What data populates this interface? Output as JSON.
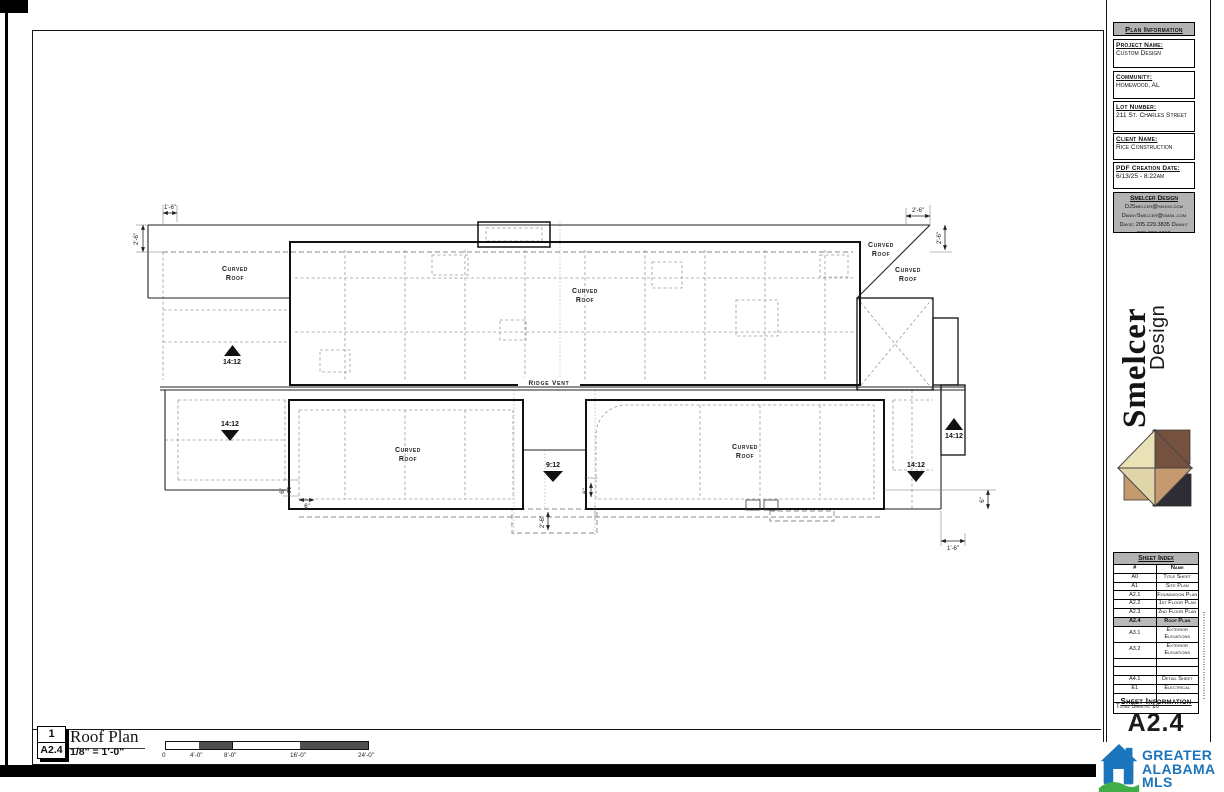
{
  "sidebar": {
    "plan_information": {
      "title": "Plan Information",
      "fields": [
        {
          "label": "Project Name:",
          "value": "Custom Design"
        },
        {
          "label": "Community:",
          "value": "Homewood, AL"
        },
        {
          "label": "Lot Number:",
          "value": "211 St. Charles Street"
        },
        {
          "label": "Client Name:",
          "value": "Rice Construction"
        },
        {
          "label": "PDF Creation Date:",
          "value": "6/13/25 - 8:22am"
        }
      ]
    },
    "designer_contact": {
      "name": "Smelcer Design",
      "lines": [
        "DJSmelcer@yahoo.com",
        "DannySmelcer@gmail.com",
        "David: 205.229.3835",
        "Danny: 205.296.1215"
      ]
    },
    "brand": {
      "word1": "Smelcer",
      "word2": "Design"
    },
    "sheet_index": {
      "title": "Sheet Index",
      "columns": {
        "num": "#",
        "name": "Name"
      },
      "rows": [
        {
          "num": "A0",
          "name": "Title Sheet"
        },
        {
          "num": "A1",
          "name": "Site Plan"
        },
        {
          "num": "A2.1",
          "name": "Foundation Plan"
        },
        {
          "num": "A2.2",
          "name": "1st Floor Plan"
        },
        {
          "num": "A2.3",
          "name": "2nd Floor Plan"
        },
        {
          "num": "A2.4",
          "name": "Roof Plan"
        },
        {
          "num": "A3.1",
          "name": "Exterior Elevations"
        },
        {
          "num": "A3.2",
          "name": "Exterior Elevations"
        },
        {
          "num": "",
          "name": ""
        },
        {
          "num": "",
          "name": ""
        },
        {
          "num": "A4.1",
          "name": "Detail Sheet"
        },
        {
          "num": "E1",
          "name": "Electrical"
        },
        {
          "num": "",
          "name": ""
        }
      ],
      "total": "Total Sheets: 10"
    },
    "sheet_information": {
      "title": "Sheet Information",
      "sheet_number": "A2.4"
    }
  },
  "mls_logo": {
    "line1": "GREATER",
    "line2": "ALABAMA",
    "line3": "MLS"
  },
  "title_block": {
    "detail_number": "1",
    "sheet_ref": "A2.4",
    "title": "Roof Plan",
    "scale": "1/8\" = 1'-0\"",
    "scale_labels": [
      "0",
      "4'-0\"",
      "8'-0\"",
      "16'-0\"",
      "24'-0\""
    ]
  },
  "plan": {
    "labels": {
      "curved": "Curved",
      "roof": "Roof",
      "ridge_vent": "Ridge Vent"
    },
    "slopes": {
      "s14": "14:12",
      "s9": "9:12"
    },
    "dims": {
      "d16": "1'-6\"",
      "d26": "2'-6\"",
      "d6": "6\""
    }
  },
  "colors": {
    "mls_blue": "#1b75bc",
    "mls_green": "#3fae49",
    "logo_cream": "#eae2b6",
    "logo_brown": "#75523f",
    "logo_tan": "#c59a6e",
    "logo_dark": "#2e2d35",
    "header_gray": "#b3b3b3"
  }
}
